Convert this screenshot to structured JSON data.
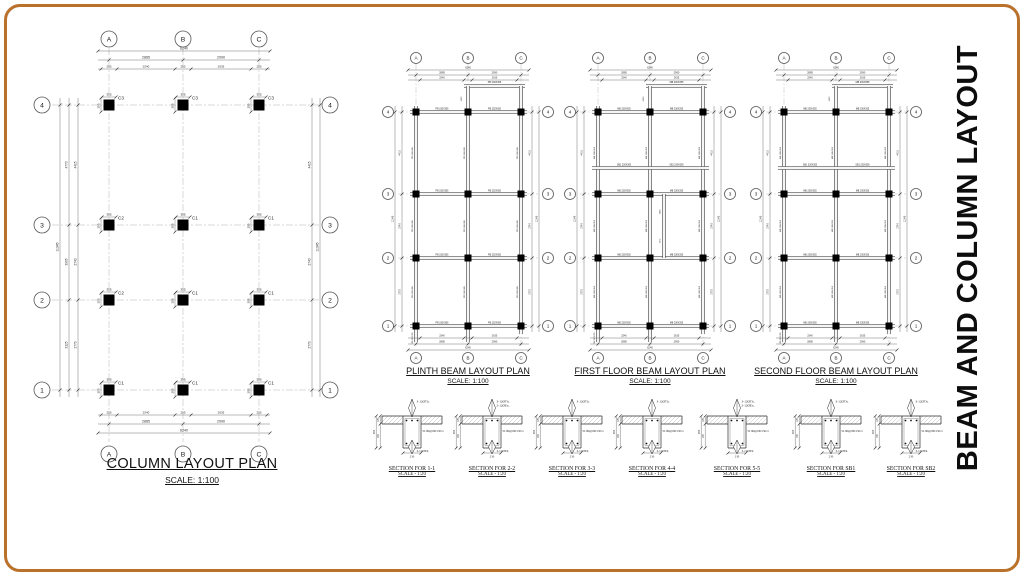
{
  "frame": {
    "border_color": "#b9712b",
    "bg": "#ffffff"
  },
  "side_title": "BEAM AND COLUMN LAYOUT",
  "grid": {
    "cols": [
      "A",
      "B",
      "C"
    ],
    "rows": [
      "4",
      "3",
      "2",
      "1"
    ]
  },
  "dims": {
    "overall_w": "6240",
    "spans_w": [
      "2885",
      "2990"
    ],
    "col_width": "255",
    "clear_spans_w": [
      "2540",
      "2635"
    ],
    "overall_h": "11345",
    "spans_h": [
      "4415",
      "2740",
      "2770"
    ],
    "outer_h": [
      "4770",
      "3905",
      "3125"
    ],
    "cantilever": "1065",
    "column_size": "355"
  },
  "column_plan": {
    "title": "COLUMN LAYOUT PLAN",
    "scale": "SCALE: 1:100",
    "marks": [
      [
        "C3",
        "C3",
        "C3"
      ],
      [
        "C2",
        "C1",
        "C1"
      ],
      [
        "C2",
        "C1",
        "C1"
      ],
      [
        "C1",
        "C1",
        "C1"
      ]
    ]
  },
  "beam_plans": [
    {
      "title": "PLINTH BEAM LAYOUT PLAN",
      "scale": "SCALE: 1:100",
      "main_beam": "PB 230X305",
      "sec_beam": "",
      "stub_beam": "TB 230X305",
      "has_sec": false,
      "has_inner_stub": false,
      "stub_dims": []
    },
    {
      "title": "FIRST FLOOR BEAM LAYOUT PLAN",
      "scale": "SCALE: 1:100",
      "main_beam": "MB 230X355",
      "sec_beam": "SB1 230X305",
      "stub_beam": "TB 230X305",
      "has_sec": true,
      "has_inner_stub": true,
      "stub_dims": [
        "1000",
        "1175"
      ]
    },
    {
      "title": "SECOND FLOOR BEAM LAYOUT PLAN",
      "scale": "SCALE: 1:100",
      "main_beam": "MB 230X355",
      "sec_beam": "SB1 230X305",
      "stub_beam": "TB 230X305",
      "has_sec": true,
      "has_inner_stub": false,
      "stub_dims": []
    }
  ],
  "sections": [
    {
      "title": "SECTION FOR 1-1",
      "scale": "SCALE - 1:20",
      "top_rebar": "3-12ØTh.",
      "extra_rebar": "",
      "bottom_rebar": "3-12ØTh.",
      "stirrups": "SL 8Ø@180/150c/c",
      "width_dim": "230",
      "depth_dim": "355",
      "slab_dim": "125",
      "stem_dim": "230"
    },
    {
      "title": "SECTION FOR 2-2",
      "scale": "SCALE - 1:20",
      "top_rebar": "3-12ØTh.",
      "extra_rebar": "2-12ØEx.",
      "bottom_rebar": "3-12ØTh.",
      "stirrups": "SL 8Ø@180/150c/c",
      "width_dim": "230",
      "depth_dim": "355",
      "slab_dim": "125",
      "stem_dim": "230"
    },
    {
      "title": "SECTION FOR 3-3",
      "scale": "SCALE - 1:20",
      "top_rebar": "3-12ØTh.",
      "extra_rebar": "",
      "bottom_rebar": "3-12ØTh.",
      "stirrups": "SL 8Ø@180/150c/c",
      "width_dim": "230",
      "depth_dim": "355",
      "slab_dim": "125",
      "stem_dim": "230"
    },
    {
      "title": "SECTION FOR 4-4",
      "scale": "SCALE - 1:20",
      "top_rebar": "3-12ØTh.",
      "extra_rebar": "",
      "bottom_rebar": "3-12ØTh.",
      "stirrups": "SL 8Ø@180/150c/c",
      "width_dim": "230",
      "depth_dim": "355",
      "slab_dim": "125",
      "stem_dim": "230"
    },
    {
      "title": "SECTION FOR 5-5",
      "scale": "SCALE - 1:20",
      "top_rebar": "3-12ØTh.",
      "extra_rebar": "2-12ØEx.",
      "bottom_rebar": "3-12ØTh.",
      "stirrups": "SL 8Ø@180/150c/c",
      "width_dim": "230",
      "depth_dim": "355",
      "slab_dim": "125",
      "stem_dim": "230"
    },
    {
      "title": "SECTION FOR SB1",
      "scale": "SCALE - 1:20",
      "top_rebar": "3-12ØTh.",
      "extra_rebar": "",
      "bottom_rebar": "3-12ØTh.",
      "stirrups": "SL 8Ø@180/150c/c",
      "width_dim": "230",
      "depth_dim": "305",
      "slab_dim": "125",
      "stem_dim": "180"
    },
    {
      "title": "SECTION FOR SB2",
      "scale": "SCALE - 1:20",
      "top_rebar": "3-12ØTh.",
      "extra_rebar": "",
      "bottom_rebar": "3-12ØTh.",
      "stirrups": "SL 8Ø@180/150c/c",
      "width_dim": "230",
      "depth_dim": "305",
      "slab_dim": "125",
      "stem_dim": "180"
    }
  ]
}
